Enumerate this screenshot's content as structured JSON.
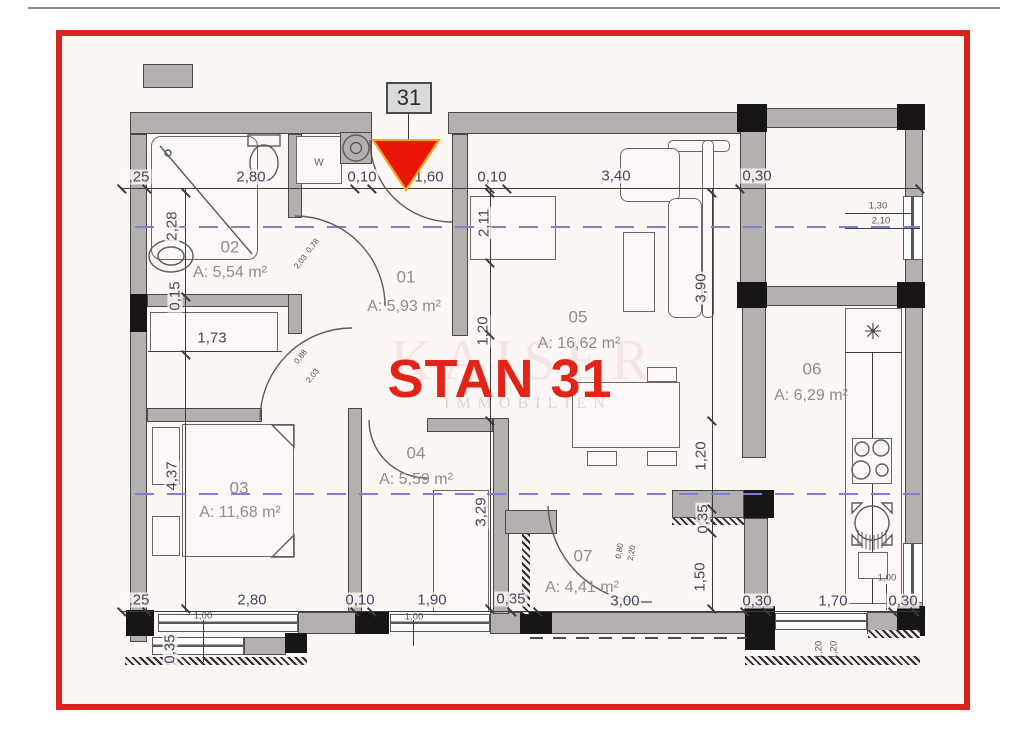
{
  "title": {
    "text": "STAN 31"
  },
  "marker": {
    "unit_number": "31"
  },
  "watermark": {
    "line1": "KAISER",
    "line2": "IMMOBILIEN"
  },
  "colors": {
    "frame_red": "#d7251d",
    "triangle_red": "#e81508",
    "triangle_rim": "#f2a41f",
    "title_red": "#e32318",
    "wall_gray": "#b4b0b0",
    "section_blue": "#7f7fdb",
    "dim_text": "#42475c",
    "room_text": "#8f8c8c"
  },
  "rooms": {
    "r01": {
      "id": "01",
      "area": "A: 5,93 m²"
    },
    "r02": {
      "id": "02",
      "area": "A: 5,54 m²"
    },
    "r03": {
      "id": "03",
      "area": "A: 11,68 m²"
    },
    "r04": {
      "id": "04",
      "area": "A: 5,59 m²"
    },
    "r05": {
      "id": "05",
      "area": "A: 16,62 m²"
    },
    "r06": {
      "id": "06",
      "area": "A: 6,29 m²"
    },
    "r07": {
      "id": "07",
      "area": "A: 4,41 m²"
    }
  },
  "dims": {
    "top": {
      "a": ",25",
      "b": "2,80",
      "c": "0,10",
      "d": "1,60",
      "e": "0,10",
      "f": "3,40",
      "g": "0,30"
    },
    "bottom": {
      "a": ",25",
      "b": "2,80",
      "c": "0,10",
      "d": "1,90",
      "e": "0,35",
      "f": "3,00",
      "g": "0,30",
      "h": "1,70",
      "i": "0,30"
    },
    "left": {
      "a": "2,28",
      "b": "0,15",
      "c": "4,37",
      "d": "0,35"
    },
    "mid": {
      "hall_h": "2,11",
      "hall_w": "1,20",
      "wardrobe": "1,73",
      "closet": "3,29"
    },
    "right": {
      "living": "3,90",
      "pass": "1,20",
      "wall": "0,35",
      "hall": "1,50"
    },
    "window": {
      "w": "1,30",
      "h": "2,10"
    },
    "sills": {
      "a": "1,00",
      "b": "1,00",
      "c": "1,00"
    },
    "balcony": {
      "a": "1,20",
      "b": "1,20"
    },
    "doors": {
      "bath": {
        "w": "0,78",
        "h": "2,03"
      },
      "bedroom": {
        "w": "0,88",
        "h": "2,03"
      },
      "entry07": {
        "w": "0,80",
        "h": "2,20"
      }
    }
  },
  "fixtures": {
    "washer": "w",
    "fridge": "✳"
  }
}
